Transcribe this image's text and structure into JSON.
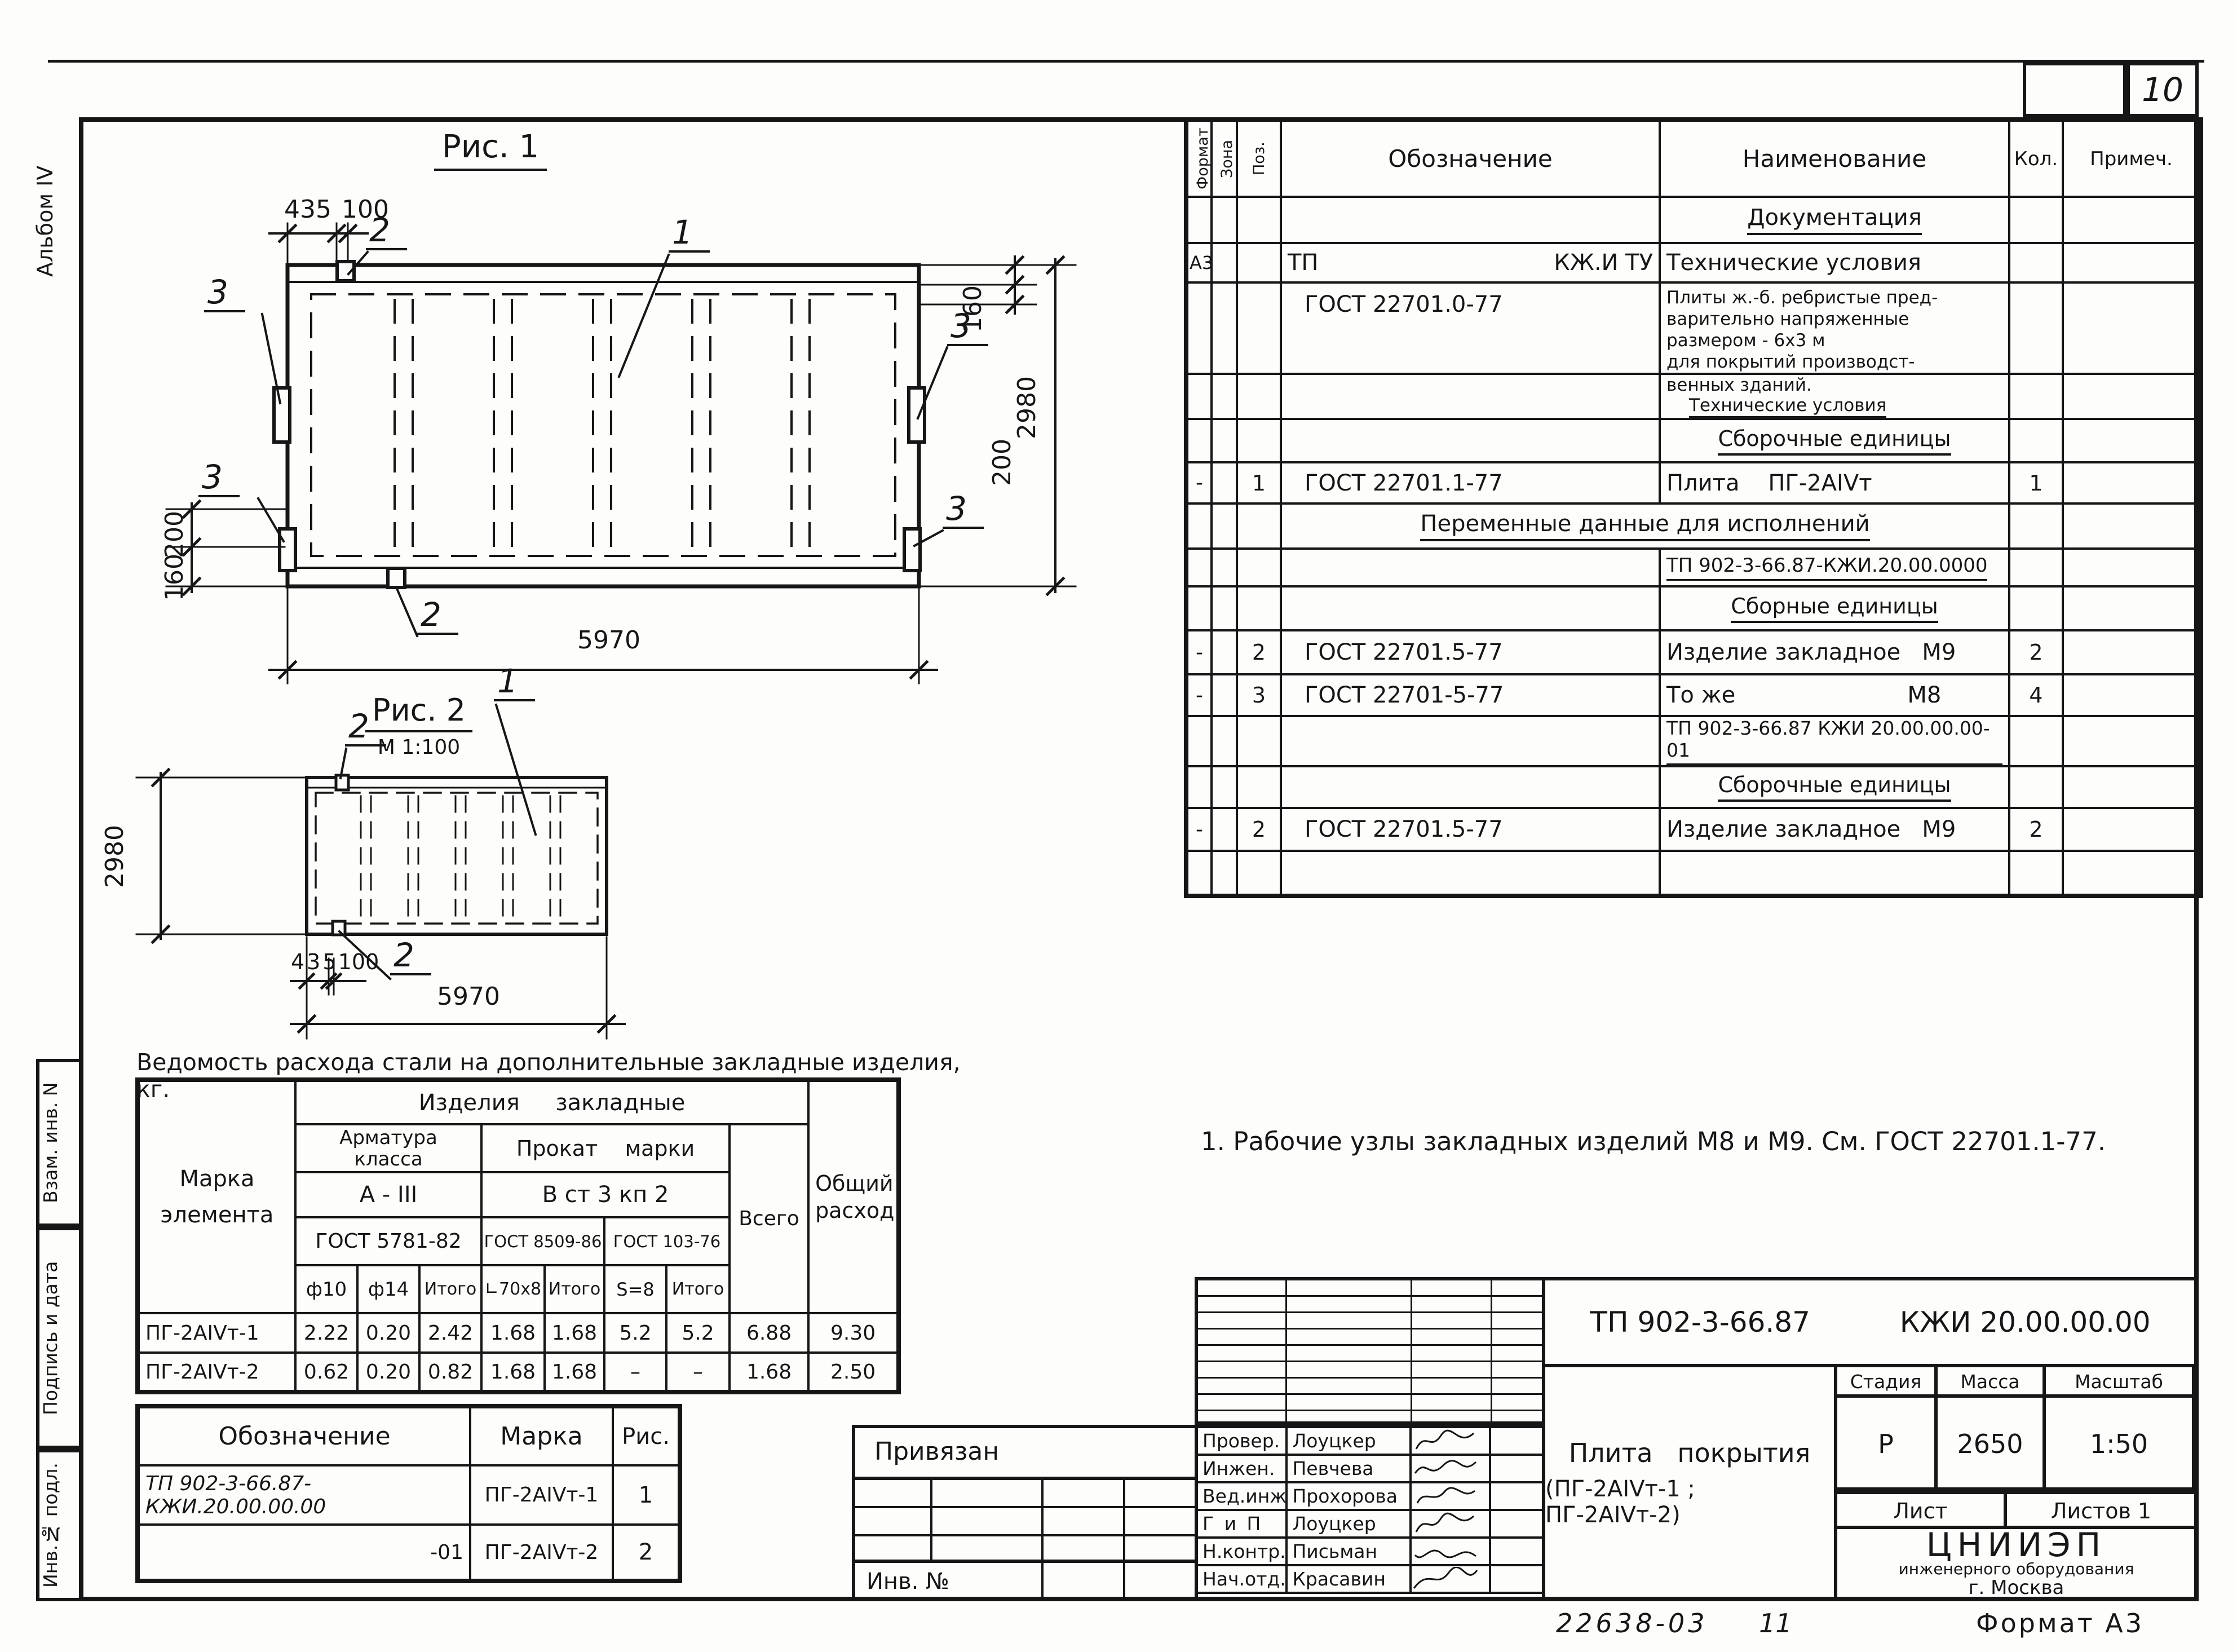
{
  "page": {
    "number": "10",
    "album": "Альбом IV",
    "footer_doc": "22638-03",
    "footer_sheet": "11",
    "footer_format": "Формат А3"
  },
  "side": {
    "vzam": "Взам. инв. N",
    "podpis": "Подпись и дата",
    "inv_podl": "Инв.№ подл."
  },
  "callouts": {
    "c1": "1",
    "c2": "2",
    "c3": "3"
  },
  "fig1": {
    "title": "Рис. 1",
    "dim_435": "435",
    "dim_100": "100",
    "dim_160_right": "160",
    "dim_200_right": "200",
    "dim_2980": "2980",
    "dim_200_left": "200",
    "dim_160_left": "160",
    "dim_5970": "5970"
  },
  "fig2": {
    "title": "Рис. 2",
    "scale": "М 1:100",
    "dim_2980": "2980",
    "dim_435": "435",
    "dim_100": "100",
    "dim_5970": "5970"
  },
  "spec": {
    "h": {
      "format": "Формат",
      "zona": "Зона",
      "poz": "Поз.",
      "oboz": "Обозначение",
      "name": "Наименование",
      "kol": "Кол.",
      "prim": "Примеч."
    },
    "r1": "Документация",
    "r2": {
      "fmt": "А3",
      "oboz_l": "ТП",
      "oboz_r": "КЖ.И ТУ",
      "name": "Технические условия"
    },
    "r3": {
      "oboz": "ГОСТ 22701.0-77",
      "name": "Плиты ж.-б. ребристые пред-\nварительно напряженные\nразмером - 6х3 м\nдля покрытий производст-"
    },
    "r4a": "венных зданий.",
    "r4b": "Технические условия",
    "r5": "Сборочные единицы",
    "r6": {
      "fmt": "-",
      "poz": "1",
      "oboz": "ГОСТ 22701.1-77",
      "name": "Плита    ПГ-2АIVт",
      "kol": "1"
    },
    "r7": "Переменные данные для исполнений",
    "r8": "ТП 902-3-66.87-КЖИ.20.00.0000",
    "r9": "Сборные единицы",
    "r10": {
      "fmt": "-",
      "poz": "2",
      "oboz": "ГОСТ 22701.5-77",
      "name": "Изделие закладное   М9",
      "kol": "2"
    },
    "r11": {
      "fmt": "-",
      "poz": "3",
      "oboz": "ГОСТ 22701-5-77",
      "name": "То же                        М8",
      "kol": "4"
    },
    "r12": "ТП 902-3-66.87 КЖИ 20.00.00.00-01",
    "r13": "Сборочные единицы",
    "r14": {
      "fmt": "-",
      "poz": "2",
      "oboz": "ГОСТ 22701.5-77",
      "name": "Изделие закладное   М9",
      "kol": "2"
    }
  },
  "note": "1. Рабочие узлы закладных  изделий  М8  и  М9. См. ГОСТ 22701.1-77.",
  "steel": {
    "title": "Ведомость расхода стали на дополнительные закладные изделия, кг.",
    "h_marka": "Марка\nэлемента",
    "h_izdeliya": "Изделия     закладные",
    "h_armatura": "Арматура\nкласса",
    "h_prokat": "Прокат    марки",
    "h_aiii": "А - III",
    "h_vst": "В ст 3  кп 2",
    "h_gost1": "ГОСТ 5781-82",
    "h_gost2": "ГОСТ 8509-86",
    "h_gost3": "ГОСТ 103-76",
    "h_vsego": "Всего",
    "h_obshiy": "Общий\nрасход",
    "h_f10": "ф10",
    "h_f14": "ф14",
    "h_itogo1": "Итого",
    "h_l70": "∟70х8",
    "h_itogo2": "Итого",
    "h_s8": "S=8",
    "h_itogo3": "Итого",
    "rows": [
      {
        "marka": "ПГ-2АIVт-1",
        "f10": "2.22",
        "f14": "0.20",
        "itogo1": "2.42",
        "l70": "1.68",
        "itogo2": "1.68",
        "s8": "5.2",
        "itogo3": "5.2",
        "vsego": "6.88",
        "obshiy": "9.30"
      },
      {
        "marka": "ПГ-2АIVт-2",
        "f10": "0.62",
        "f14": "0.20",
        "itogo1": "0.82",
        "l70": "1.68",
        "itogo2": "1.68",
        "s8": "–",
        "itogo3": "–",
        "vsego": "1.68",
        "obshiy": "2.50"
      }
    ]
  },
  "designation": {
    "h_oboz": "Обозначение",
    "h_marka": "Марка",
    "h_ris": "Рис.",
    "rows": [
      {
        "oboz": "ТП 902-3-66.87-КЖИ.20.00.00.00",
        "marka": "ПГ-2АIVт-1",
        "ris": "1"
      },
      {
        "oboz": "-01",
        "marka": "ПГ-2АIVт-2",
        "ris": "2"
      }
    ]
  },
  "stamp": {
    "privyazan": "Привязан",
    "inv_no": "Инв. №",
    "sig_rows": [
      {
        "role": "Провер.",
        "name": "Лоуцкер"
      },
      {
        "role": "Инжен.",
        "name": "Певчева"
      },
      {
        "role": "Вед.инж",
        "name": "Прохорова"
      },
      {
        "role": "Г и П",
        "name": "Лоуцкер"
      },
      {
        "role": "Н.контр.",
        "name": "Письман"
      },
      {
        "role": "Нач.отд.",
        "name": "Красавин"
      }
    ],
    "doc_left": "ТП 902-3-66.87",
    "doc_right": "КЖИ 20.00.00.00",
    "title_1": "Плита   покрытия",
    "title_2": "(ПГ-2АIVт-1 ; ПГ-2АIVт-2)",
    "h_stadia": "Стадия",
    "h_massa": "Масса",
    "h_masshtab": "Масштаб",
    "stadia": "Р",
    "massa": "2650",
    "masshtab": "1:50",
    "list": "Лист",
    "listov": "Листов 1",
    "org_1": "ЦНИИЭП",
    "org_2": "инженерного оборудования",
    "org_3": "г. Москва"
  }
}
